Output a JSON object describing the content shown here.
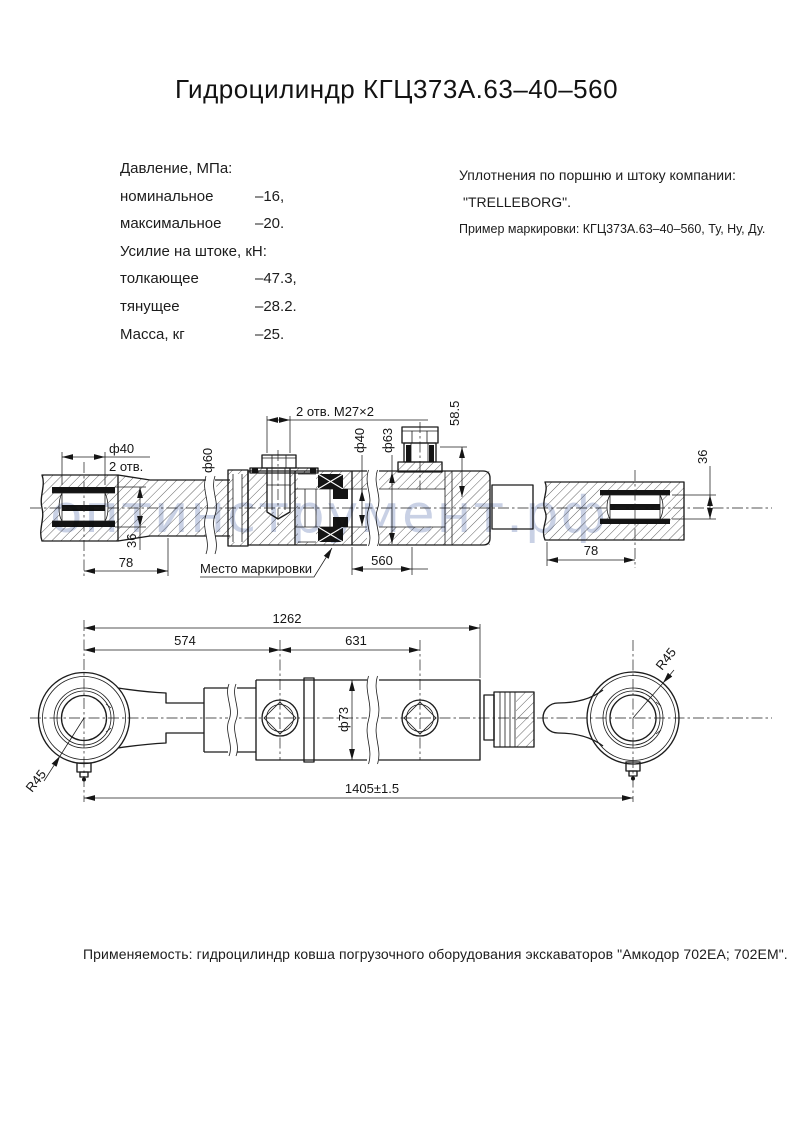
{
  "title": "Гидроцилиндр КГЦ373А.63–40–560",
  "specs": {
    "rows": [
      {
        "label": "Давление, МПа:",
        "value": ""
      },
      {
        "label": "номинальное",
        "value": "–16,"
      },
      {
        "label": "максимальное",
        "value": "–20."
      },
      {
        "label": "Усилие на штоке, кН:",
        "value": ""
      },
      {
        "label": "толкающее",
        "value": "–47.3,"
      },
      {
        "label": "тянущее",
        "value": "–28.2."
      },
      {
        "label": "Масса, кг",
        "value": "–25."
      }
    ]
  },
  "seal_note": {
    "line1": "Уплотнения по поршню и штоку компании:",
    "line2": "\"TRELLEBORG\".",
    "line3": "Пример маркировки: КГЦ373А.63–40–560, Ту, Ну, Ду."
  },
  "section_view": {
    "pin_dia": "ф40",
    "pin_holes": "2 отв.",
    "rod_dia60": "ф60",
    "ports_label": "2 отв. М27×2",
    "rod_dia40": "ф40",
    "bore_dia63": "ф63",
    "port_height": "58.5",
    "bearing_width_left": "36",
    "bearing_width_right": "36",
    "eye_len_left": "78",
    "stroke_len": "560",
    "eye_len_right": "78",
    "marking_note": "Место маркировки"
  },
  "outline_view": {
    "len_total_cyl": "1262",
    "len_rod_part": "574",
    "len_barrel_part": "631",
    "barrel_dia": "ф73",
    "eye_radius_left": "R45",
    "eye_radius_right": "R45",
    "len_overall": "1405±1.5"
  },
  "watermark": "оптинструмент.рф",
  "application": "Применяемость: гидроцилиндр ковша погрузочного оборудования экскаваторов \"Амкодор 702ЕА; 702ЕМ\".",
  "colors": {
    "line": "#1c1c1c",
    "watermark": "#9dabd0"
  }
}
